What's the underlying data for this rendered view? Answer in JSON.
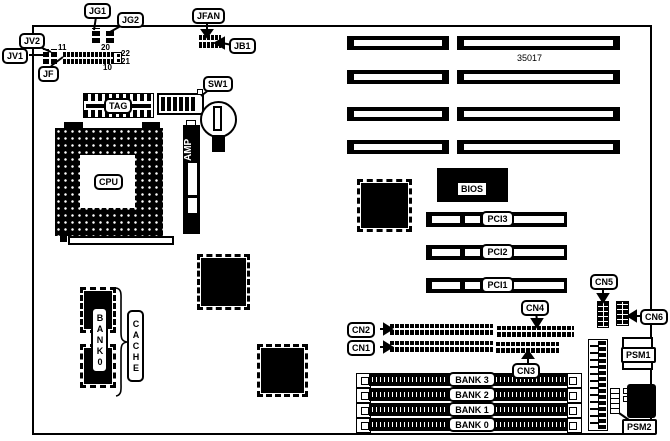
{
  "diagram": {
    "part_number": "35017",
    "jumpers": {
      "jg1": "JG1",
      "jg2": "JG2",
      "jv2": "JV2",
      "jv1": "JV1",
      "jf": "JF"
    },
    "switch": {
      "sw1": "SW1"
    },
    "connectors": {
      "jfan": "JFAN",
      "jb1": "JB1",
      "cn1": "CN1",
      "cn2": "CN2",
      "cn3": "CN3",
      "cn4": "CN4",
      "cn5": "CN5",
      "cn6": "CN6",
      "psm1": "PSM1",
      "psm2": "PSM2"
    },
    "chips": {
      "tag": "TAG",
      "amp": "AMP",
      "cpu": "CPU",
      "bios": "BIOS"
    },
    "slots": {
      "pci1": "PCI1",
      "pci2": "PCI2",
      "pci3": "PCI3"
    },
    "memory": {
      "bank3": "BANK 3",
      "bank2": "BANK 2",
      "bank1": "BANK 1",
      "bank0": "BANK 0",
      "bank0_vertical": "BANK0",
      "cache": "CACHE"
    },
    "pin_numbers": {
      "p11": "11",
      "p20": "20",
      "p10": "10",
      "p22": "22",
      "p21": "21"
    }
  },
  "colors": {
    "ink": "#000000",
    "paper": "#ffffff"
  }
}
